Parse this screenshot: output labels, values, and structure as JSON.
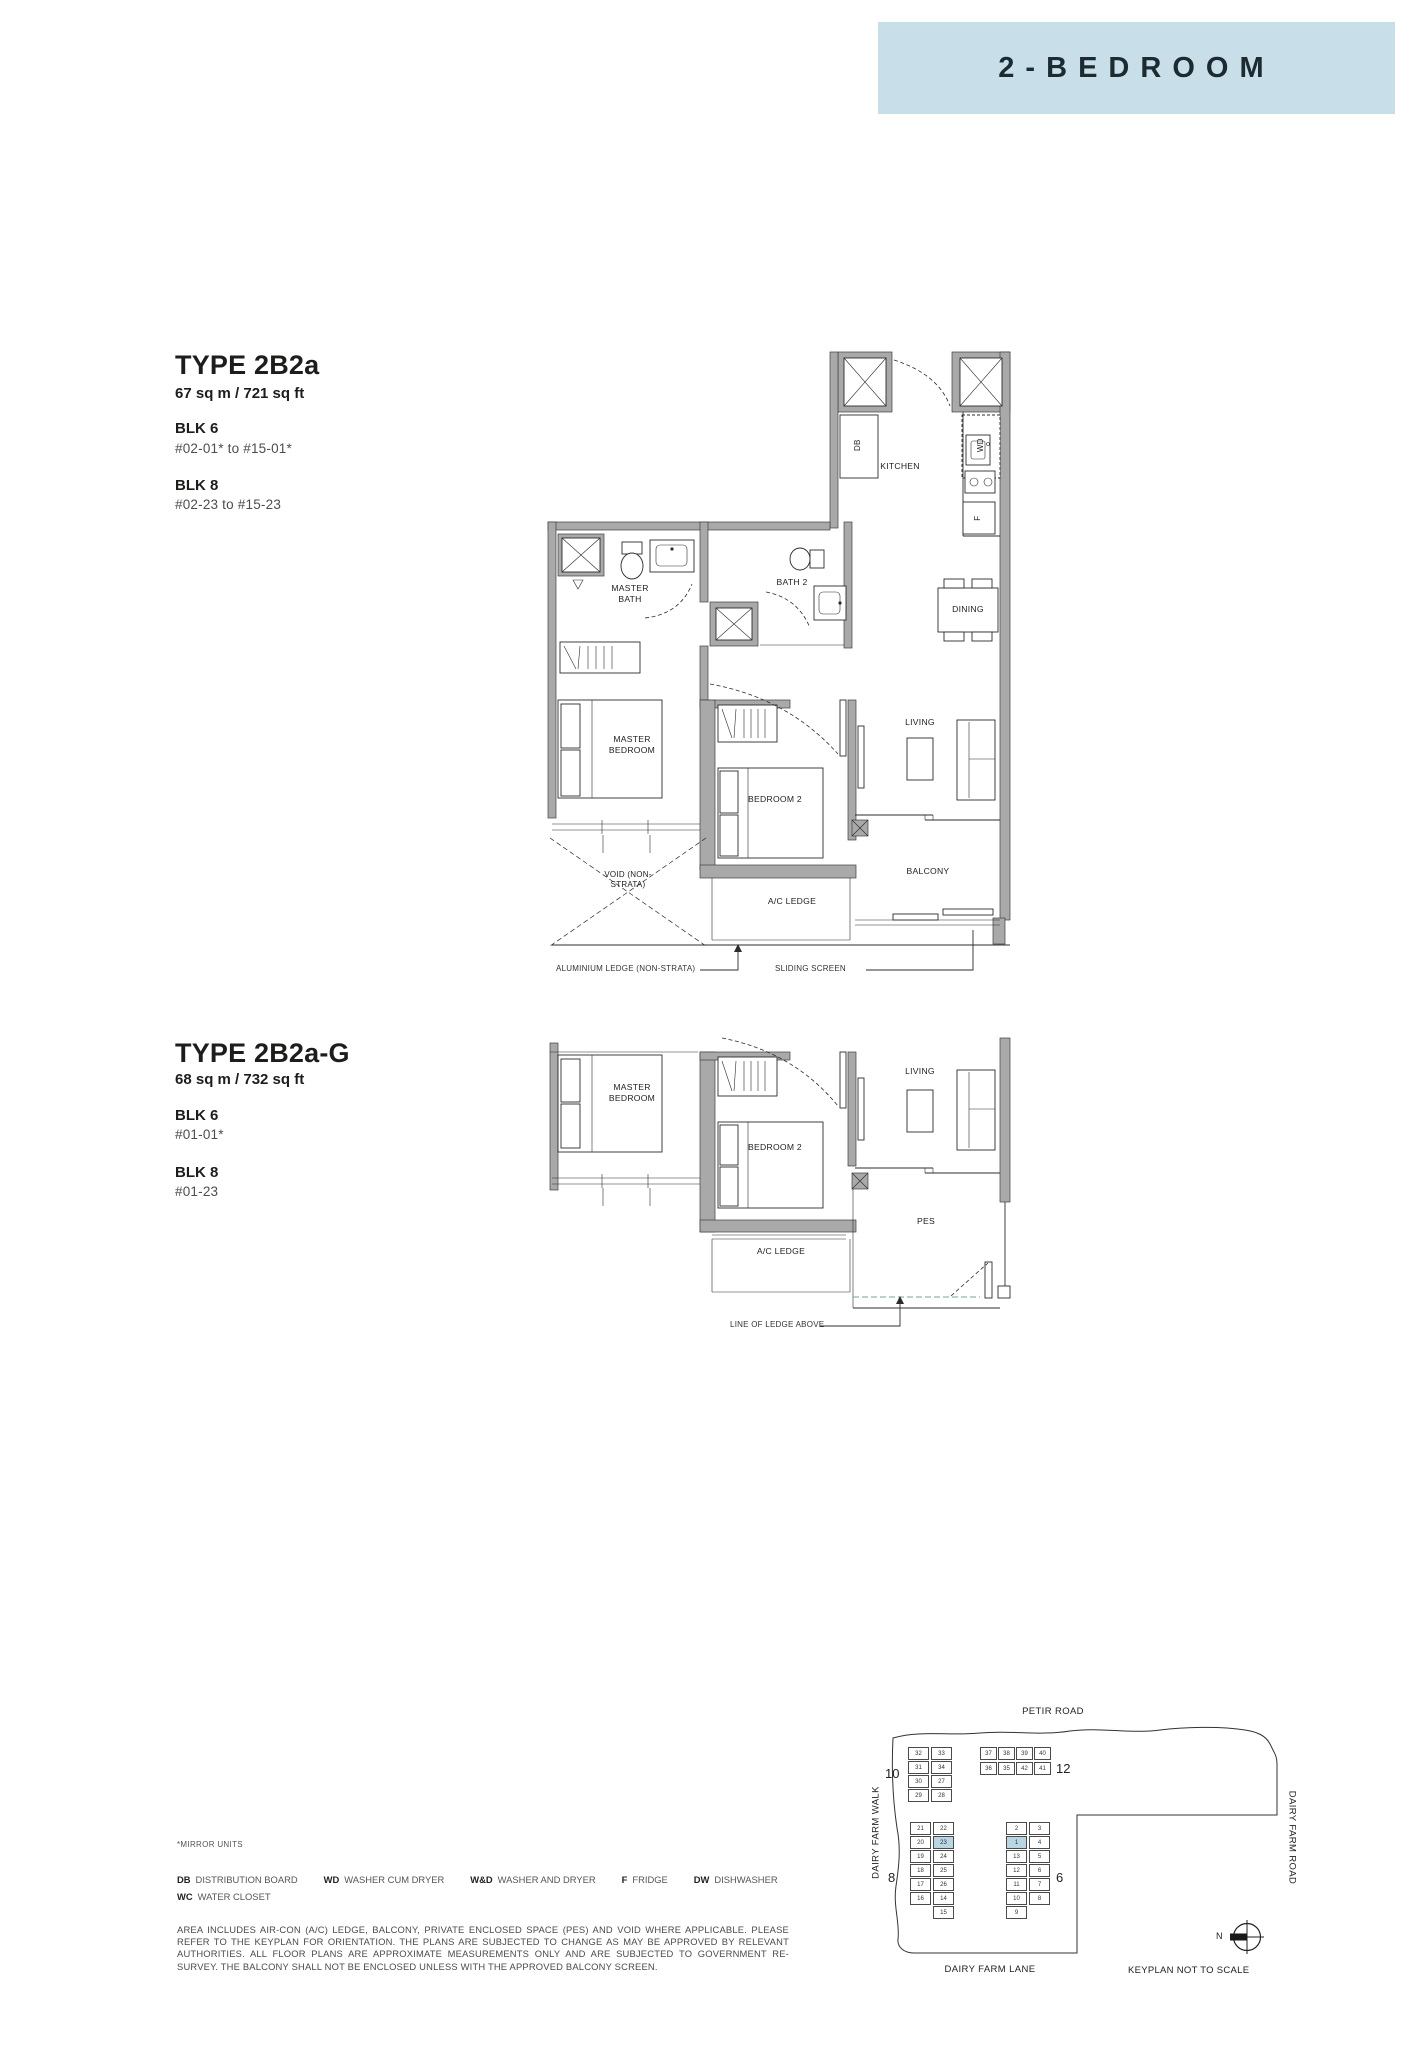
{
  "header": {
    "title": "2-BEDROOM"
  },
  "types": [
    {
      "title": "TYPE 2B2a",
      "area": "67 sq m / 721 sq ft",
      "blocks": [
        {
          "name": "BLK 6",
          "units": "#02-01* to #15-01*"
        },
        {
          "name": "BLK 8",
          "units": "#02-23  to #15-23"
        }
      ]
    },
    {
      "title": "TYPE 2B2a-G",
      "area": "68 sq m / 732 sq ft",
      "blocks": [
        {
          "name": "BLK 6",
          "units": "#01-01*"
        },
        {
          "name": "BLK 8",
          "units": "#01-23"
        }
      ]
    }
  ],
  "plan1": {
    "kitchen": "KITCHEN",
    "dining": "DINING",
    "master_bath": "MASTER BATH",
    "bath2": "BATH 2",
    "master_bedroom": "MASTER BEDROOM",
    "bedroom2": "BEDROOM 2",
    "living": "LIVING",
    "balcony": "BALCONY",
    "void": "VOID (NON-STRATA)",
    "ac_ledge": "A/C LEDGE",
    "db": "DB",
    "wd": "WD",
    "fridge": "F",
    "ann_ledge": "ALUMINIUM LEDGE (NON-STRATA)",
    "ann_screen": "SLIDING SCREEN"
  },
  "plan2": {
    "master_bedroom": "MASTER BEDROOM",
    "bedroom2": "BEDROOM 2",
    "living": "LIVING",
    "pes": "PES",
    "ac_ledge": "A/C LEDGE",
    "ann_ledge_above": "LINE OF LEDGE ABOVE"
  },
  "notes": {
    "mirror": "*MIRROR UNITS",
    "legend_row1": [
      {
        "k": "DB",
        "v": "DISTRIBUTION BOARD"
      },
      {
        "k": "WD",
        "v": "WASHER CUM DRYER"
      },
      {
        "k": "W&D",
        "v": "WASHER AND DRYER"
      },
      {
        "k": "F",
        "v": "FRIDGE"
      },
      {
        "k": "DW",
        "v": "DISHWASHER"
      }
    ],
    "legend_row2": [
      {
        "k": "WC",
        "v": "WATER CLOSET"
      }
    ],
    "disclaimer": "AREA INCLUDES AIR-CON (A/C) LEDGE, BALCONY, PRIVATE ENCLOSED SPACE (PES) AND VOID WHERE APPLICABLE. PLEASE REFER TO THE KEYPLAN FOR ORIENTATION. THE PLANS ARE SUBJECTED TO CHANGE AS MAY BE APPROVED BY RELEVANT AUTHORITIES. ALL FLOOR PLANS ARE APPROXIMATE MEASUREMENTS ONLY AND ARE SUBJECTED TO GOVERNMENT RE-SURVEY. THE BALCONY SHALL NOT BE ENCLOSED UNLESS WITH THE APPROVED BALCONY SCREEN."
  },
  "keyplan": {
    "roads": {
      "top": "PETIR ROAD",
      "left": "DAIRY FARM WALK",
      "right": "DAIRY FARM ROAD",
      "bottom": "DAIRY FARM LANE"
    },
    "note": "KEYPLAN NOT TO SCALE",
    "north": "N",
    "blk10": {
      "label": "10",
      "col1": [
        {
          "n": "32"
        },
        {
          "n": "31"
        },
        {
          "n": "30"
        },
        {
          "n": "29"
        }
      ],
      "col2": [
        {
          "n": "33"
        },
        {
          "n": "34"
        },
        {
          "n": "27"
        },
        {
          "n": "28"
        }
      ]
    },
    "blk12": {
      "label": "12",
      "row1": [
        {
          "n": "37"
        },
        {
          "n": "38"
        },
        {
          "n": "39"
        },
        {
          "n": "40"
        }
      ],
      "row2": [
        {
          "n": "36"
        },
        {
          "n": "35"
        },
        {
          "n": "42"
        },
        {
          "n": "41"
        }
      ]
    },
    "blk8": {
      "label": "8",
      "col1": [
        {
          "n": "21"
        },
        {
          "n": "20"
        },
        {
          "n": "19"
        },
        {
          "n": "18"
        },
        {
          "n": "17"
        },
        {
          "n": "16"
        }
      ],
      "col2": [
        {
          "n": "22"
        },
        {
          "n": "23",
          "hl": true
        },
        {
          "n": "24"
        },
        {
          "n": "25"
        },
        {
          "n": "26"
        },
        {
          "n": "14"
        },
        {
          "n": "15"
        }
      ]
    },
    "blk6": {
      "label": "6",
      "col1": [
        {
          "n": "2"
        },
        {
          "n": "1",
          "hl": true
        },
        {
          "n": "13"
        },
        {
          "n": "12"
        },
        {
          "n": "11"
        },
        {
          "n": "10"
        },
        {
          "n": "9"
        }
      ],
      "col2": [
        {
          "n": "3"
        },
        {
          "n": "4"
        },
        {
          "n": "5"
        },
        {
          "n": "6"
        },
        {
          "n": "7"
        },
        {
          "n": "8"
        }
      ]
    }
  },
  "colors": {
    "accent": "#c8dfe9",
    "highlight": "#b9d7e3"
  }
}
